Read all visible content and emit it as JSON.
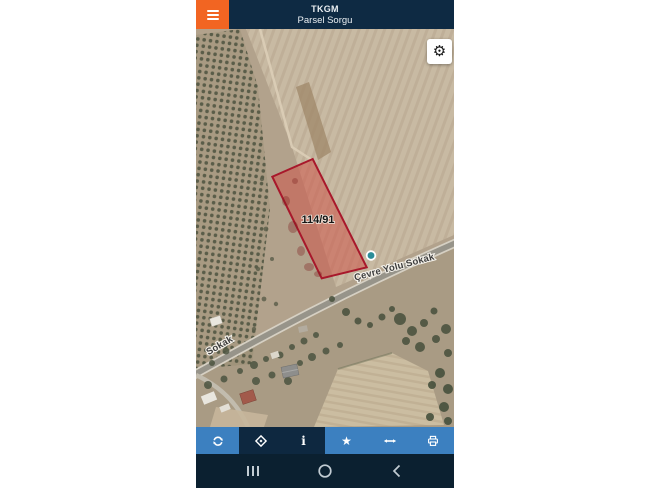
{
  "app": {
    "title": "TKGM",
    "subtitle": "Parsel Sorgu"
  },
  "map": {
    "parcel_label": "114/91",
    "street_label_main": "Çevre Yolu Sokak",
    "street_label_side": "Sokak",
    "settings_glyph": "⚙",
    "marker": "teal-location-dot"
  },
  "toolbar": {
    "buttons": [
      {
        "name": "refresh",
        "icon": "refresh-icon",
        "active": false
      },
      {
        "name": "locate",
        "icon": "locate-icon",
        "active": true
      },
      {
        "name": "info",
        "icon": "info-icon",
        "active": true,
        "glyph": "i"
      },
      {
        "name": "favorite",
        "icon": "star-icon",
        "active": false,
        "glyph": "★"
      },
      {
        "name": "measure",
        "icon": "measure-icon",
        "active": false
      },
      {
        "name": "print",
        "icon": "printer-icon",
        "active": false
      }
    ]
  },
  "android_nav": {
    "items": [
      "recents",
      "home",
      "back"
    ]
  },
  "colors": {
    "header_bg": "#0e2a43",
    "accent_orange": "#f26522",
    "toolbar_blue": "#3c80c0",
    "toolbar_dark": "#0e2840",
    "navbar_bg": "#0b2030",
    "parcel_stroke": "#a8182b",
    "parcel_fill": "rgba(205,85,75,0.55)",
    "marker_teal": "#2b8d98",
    "map_base": "#b2a28c"
  }
}
